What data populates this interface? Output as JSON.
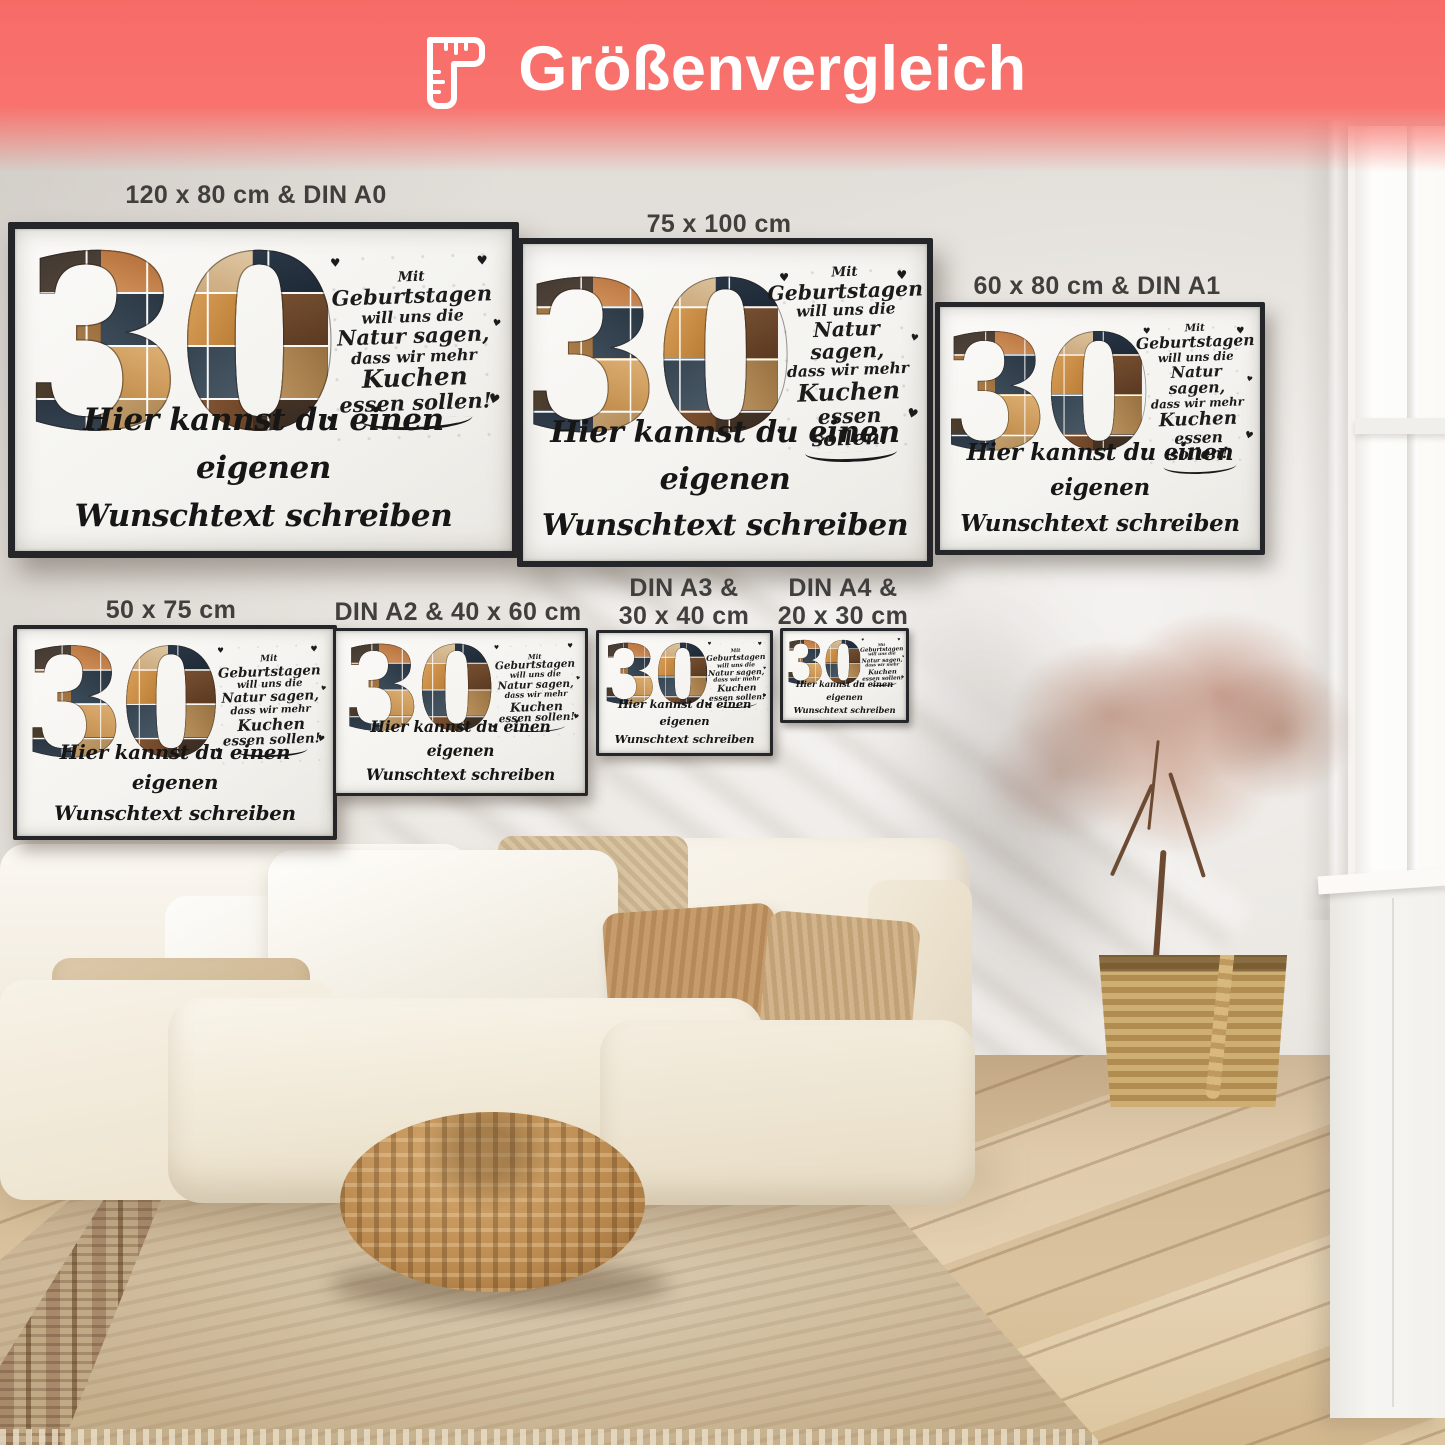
{
  "banner": {
    "title": "Größenvergleich",
    "icon": "ruler-icon",
    "background_color": "#f8706d",
    "text_color": "#ffffff"
  },
  "poster_design": {
    "number": "30",
    "quote_lines": [
      {
        "text": "Mit",
        "size": "s"
      },
      {
        "text": "Geburtstagen",
        "size": "l"
      },
      {
        "text": "will uns die",
        "size": "m"
      },
      {
        "text": "Natur sagen,",
        "size": "l"
      },
      {
        "text": "dass wir mehr",
        "size": "m"
      },
      {
        "text": "Kuchen",
        "size": "xl"
      },
      {
        "text": "essen sollen!",
        "size": "l"
      }
    ],
    "custom_text_lines": [
      "Hier kannst du einen eigenen",
      "Wunschtext schreiben"
    ],
    "decor_heart": "♥"
  },
  "posters": [
    {
      "name": "poster-120x80-din-a0",
      "label_lines": [
        "120 x 80 cm & DIN A0"
      ]
    },
    {
      "name": "poster-75x100",
      "label_lines": [
        "75 x 100 cm"
      ]
    },
    {
      "name": "poster-60x80-din-a1",
      "label_lines": [
        "60 x 80 cm & DIN A1"
      ]
    },
    {
      "name": "poster-50x75",
      "label_lines": [
        "50 x 75 cm"
      ]
    },
    {
      "name": "poster-din-a2-40x60",
      "label_lines": [
        "DIN A2 & 40 x 60 cm"
      ]
    },
    {
      "name": "poster-din-a3-30x40",
      "label_lines": [
        "DIN A3 &",
        "30 x 40 cm"
      ]
    },
    {
      "name": "poster-din-a4-20x30",
      "label_lines": [
        "DIN A4 &",
        "20 x 30 cm"
      ]
    }
  ]
}
